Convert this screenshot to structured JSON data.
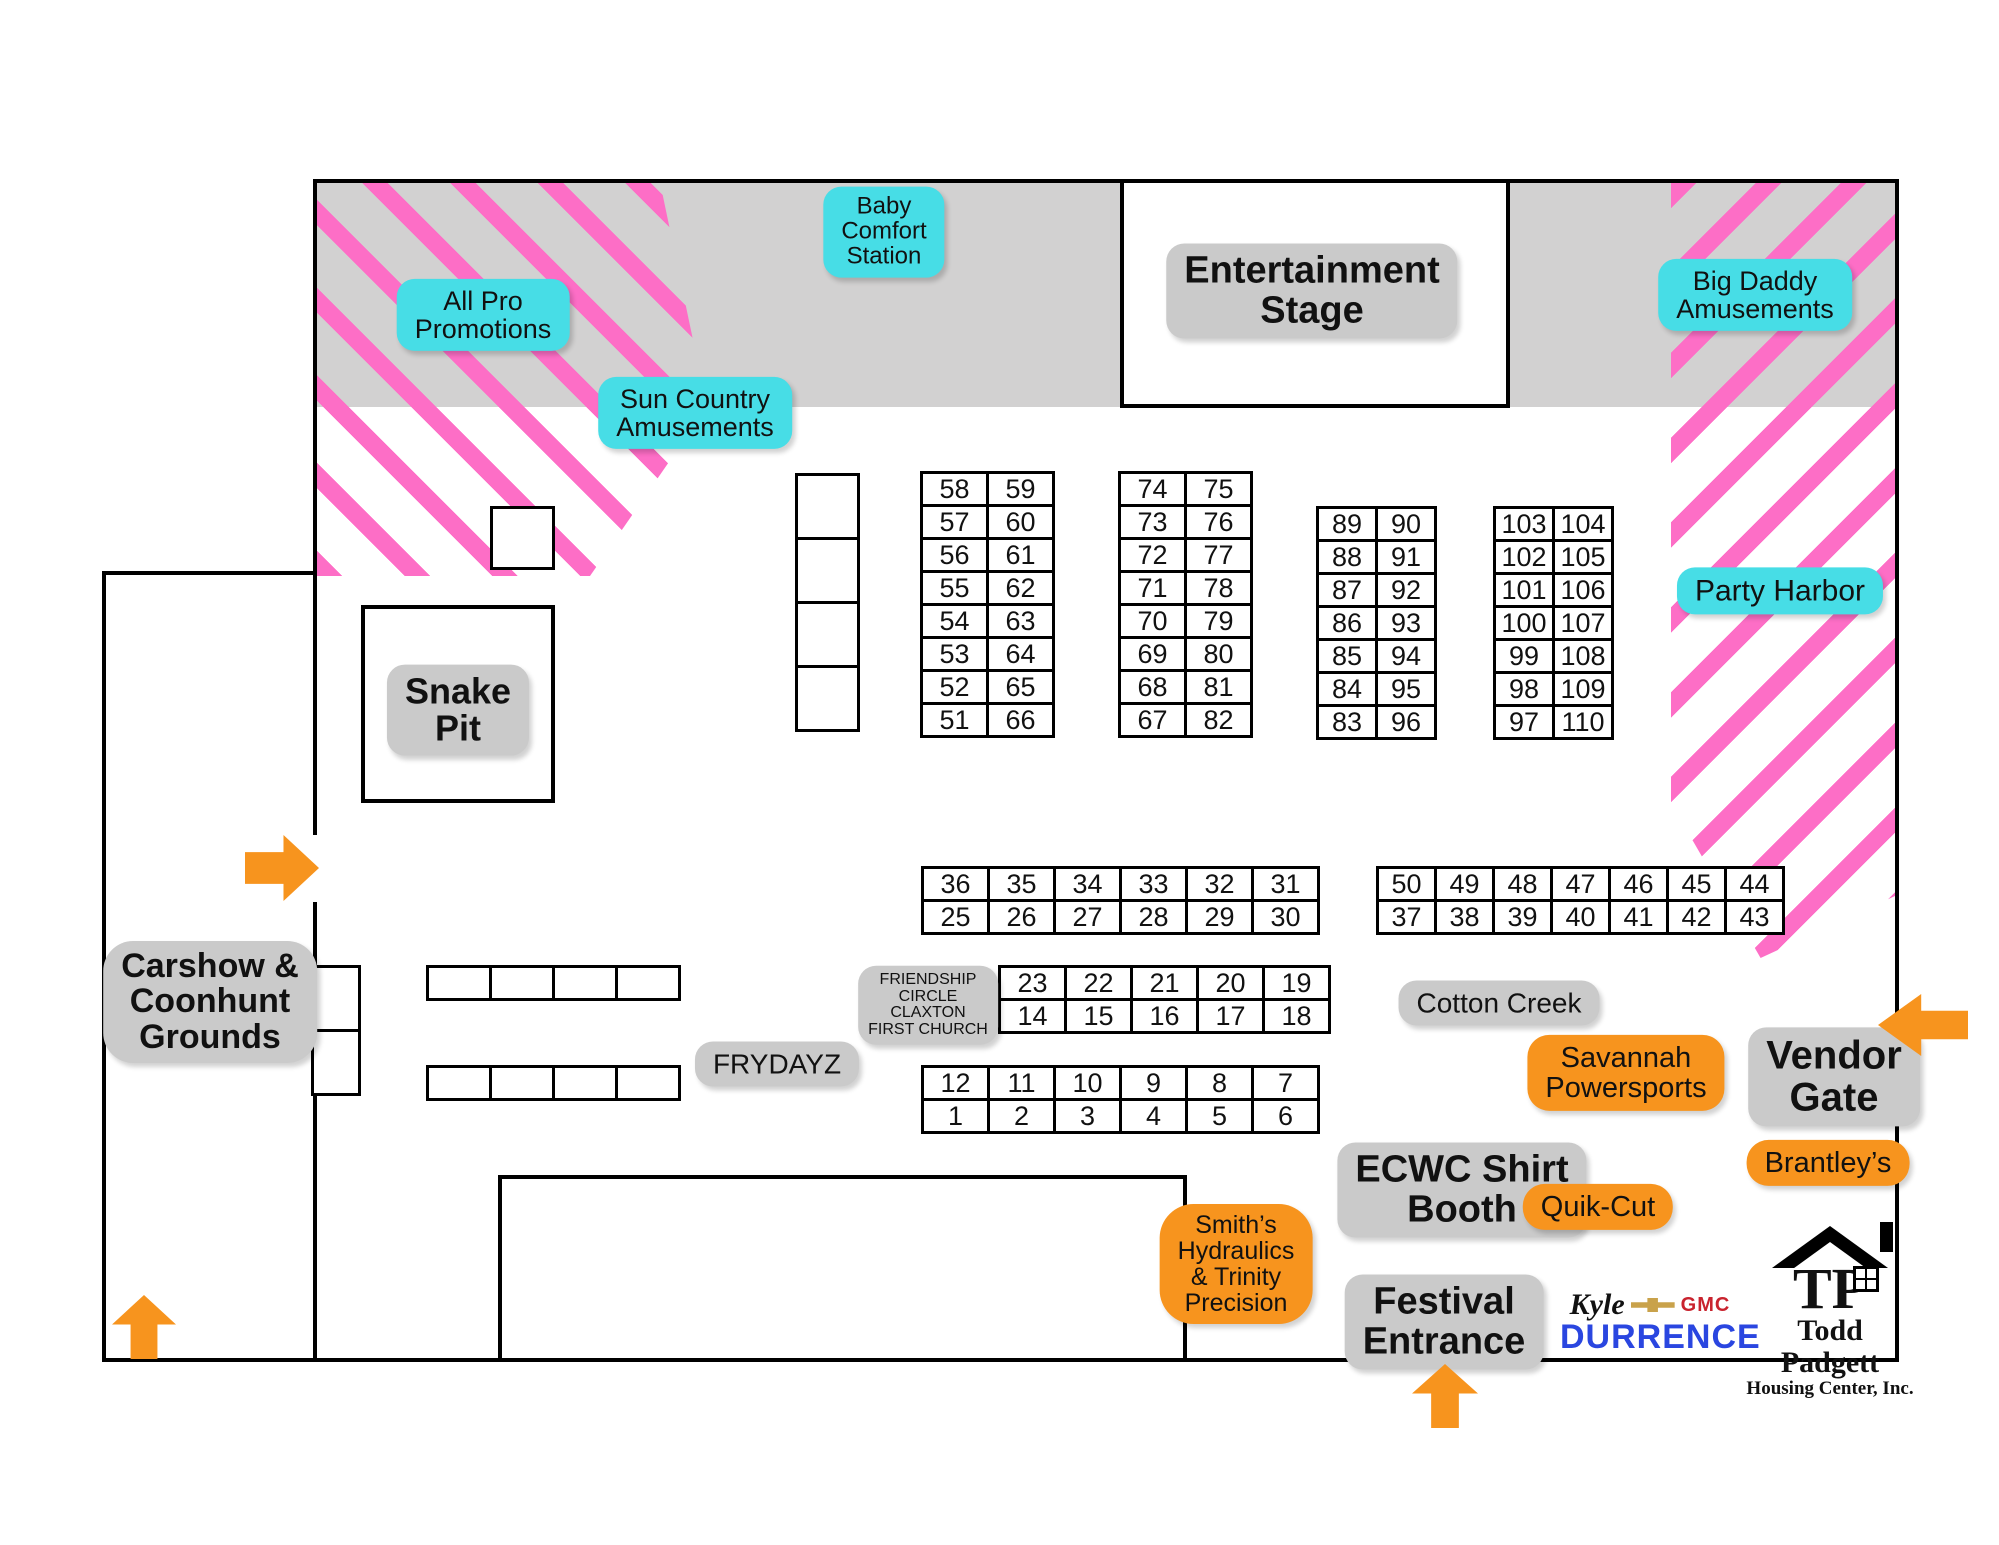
{
  "colors": {
    "pink_stripe": "#fd6ec6",
    "cyan_label": "#47dde6",
    "orange_label": "#f7941e",
    "gray_band": "#d2d1d1",
    "gray_label": "#cacaca",
    "durrence_blue": "#2a46e0",
    "gmc_red": "#c9232e",
    "bowtie_gold": "#c9a24b"
  },
  "zones": {
    "all_pro": "All Pro\nPromotions",
    "sun_country": "Sun Country\nAmusements",
    "baby_comfort": "Baby\nComfort\nStation",
    "big_daddy": "Big Daddy\nAmusements",
    "party_harbor": "Party Harbor"
  },
  "places": {
    "entertainment_stage": "Entertainment\nStage",
    "snake_pit": "Snake\nPit",
    "carshow": "Carshow &\nCoonhunt\nGrounds",
    "frydayz": "FRYDAYZ",
    "friendship_circle": "FRIENDSHIP\nCIRCLE\nCLAXTON\nFIRST CHURCH",
    "cotton_creek": "Cotton Creek",
    "ecwc": "ECWC Shirt\nBooth",
    "festival_entrance": "Festival\nEntrance",
    "vendor_gate": "Vendor\nGate"
  },
  "sponsors": {
    "savannah": "Savannah\nPowersports",
    "quik_cut": "Quik-Cut",
    "brantleys": "Brantley’s",
    "smiths": "Smith’s\nHydraulics\n& Trinity\nPrecision"
  },
  "logos": {
    "kyle_script": "Kyle",
    "gmc": "GMC",
    "durrence": "DURRENCE",
    "tp": "TP",
    "todd_name": "Todd Padgett",
    "todd_sub": "Housing Center, Inc."
  },
  "grids": {
    "grid_51_66": {
      "rows": [
        [
          "58",
          "59"
        ],
        [
          "57",
          "60"
        ],
        [
          "56",
          "61"
        ],
        [
          "55",
          "62"
        ],
        [
          "54",
          "63"
        ],
        [
          "53",
          "64"
        ],
        [
          "52",
          "65"
        ],
        [
          "51",
          "66"
        ]
      ]
    },
    "grid_67_82": {
      "rows": [
        [
          "74",
          "75"
        ],
        [
          "73",
          "76"
        ],
        [
          "72",
          "77"
        ],
        [
          "71",
          "78"
        ],
        [
          "70",
          "79"
        ],
        [
          "69",
          "80"
        ],
        [
          "68",
          "81"
        ],
        [
          "67",
          "82"
        ]
      ]
    },
    "grid_83_96": {
      "rows": [
        [
          "89",
          "90"
        ],
        [
          "88",
          "91"
        ],
        [
          "87",
          "92"
        ],
        [
          "86",
          "93"
        ],
        [
          "85",
          "94"
        ],
        [
          "84",
          "95"
        ],
        [
          "83",
          "96"
        ]
      ]
    },
    "grid_97_110": {
      "rows": [
        [
          "103",
          "104"
        ],
        [
          "102",
          "105"
        ],
        [
          "101",
          "106"
        ],
        [
          "100",
          "107"
        ],
        [
          "99",
          "108"
        ],
        [
          "98",
          "109"
        ],
        [
          "97",
          "110"
        ]
      ]
    },
    "grid_25_36": {
      "rows": [
        [
          "36",
          "35",
          "34",
          "33",
          "32",
          "31"
        ],
        [
          "25",
          "26",
          "27",
          "28",
          "29",
          "30"
        ]
      ]
    },
    "grid_37_50": {
      "rows": [
        [
          "50",
          "49",
          "48",
          "47",
          "46",
          "45",
          "44"
        ],
        [
          "37",
          "38",
          "39",
          "40",
          "41",
          "42",
          "43"
        ]
      ]
    },
    "grid_14_23": {
      "rows": [
        [
          "23",
          "22",
          "21",
          "20",
          "19"
        ],
        [
          "14",
          "15",
          "16",
          "17",
          "18"
        ]
      ]
    },
    "grid_1_12": {
      "rows": [
        [
          "12",
          "11",
          "10",
          "9",
          "8",
          "7"
        ],
        [
          "1",
          "2",
          "3",
          "4",
          "5",
          "6"
        ]
      ]
    },
    "empty_column": {
      "rows": [
        [
          ""
        ],
        [
          ""
        ],
        [
          ""
        ],
        [
          ""
        ]
      ]
    },
    "empty_row_upper": {
      "rows": [
        [
          "",
          "",
          "",
          ""
        ]
      ]
    },
    "empty_row_lower": {
      "rows": [
        [
          "",
          "",
          "",
          ""
        ]
      ]
    },
    "border_boxes": {
      "rows": [
        [
          ""
        ],
        [
          ""
        ]
      ]
    }
  }
}
